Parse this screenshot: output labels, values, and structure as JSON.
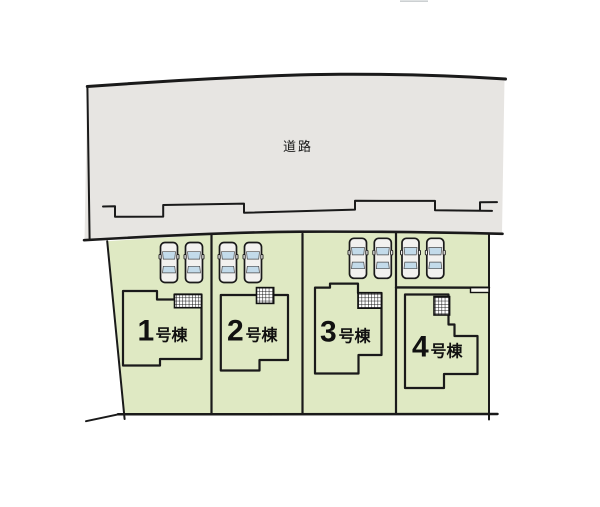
{
  "road": {
    "label": "道路",
    "fill": "#e7e5e2"
  },
  "site": {
    "lot_fill": "#dfe9c3",
    "house_fill": "#fafae9",
    "outline_color": "#1a1a1a",
    "car_body_color": "#f2f1ef",
    "car_window_color": "#c3dbea"
  },
  "lots": [
    {
      "number": "1",
      "suffix": "号棟",
      "cars": 2
    },
    {
      "number": "2",
      "suffix": "号棟",
      "cars": 2
    },
    {
      "number": "3",
      "suffix": "号棟",
      "cars": 2
    },
    {
      "number": "4",
      "suffix": "号棟",
      "cars": 2
    }
  ]
}
